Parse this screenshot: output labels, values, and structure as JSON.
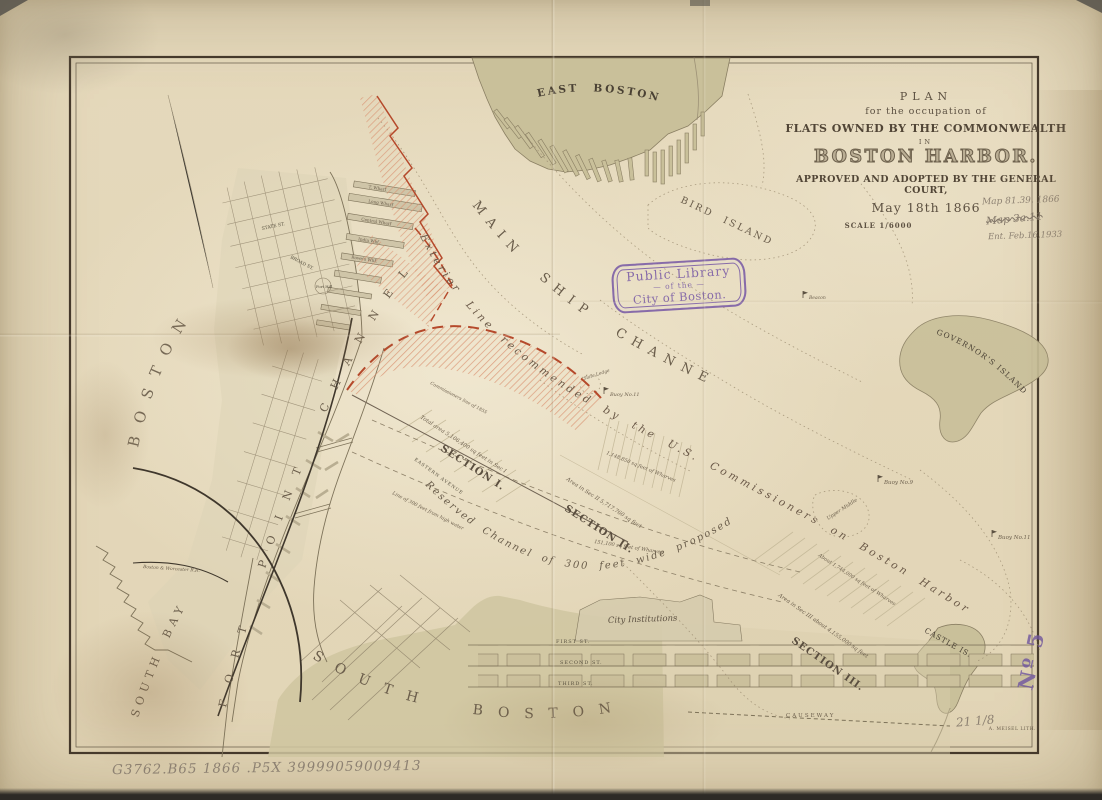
{
  "title_block": {
    "plan": "PLAN",
    "occupation": "for the occupation of",
    "flats": "FLATS OWNED BY THE COMMONWEALTH",
    "in_word": "IN",
    "harbor": "BOSTON HARBOR.",
    "approved": "APPROVED AND ADOPTED BY THE GENERAL COURT,",
    "date": "May 18th 1866",
    "scale": "SCALE 1/6000"
  },
  "manuscript": {
    "note1": "Map 81.39. 1866",
    "note2": "Map 3a.11",
    "note3": "Ent. Feb.16,1933",
    "catalog": "G3762.B65 1866 .P5X 39999059009413",
    "measure": "21 1/8"
  },
  "stamps": {
    "library_line1": "Public Library",
    "library_dash": "—",
    "library_line2": "of the",
    "library_line3": "City of Boston.",
    "number_stamp": "Nº 5"
  },
  "imprint": "A. MEISEL LITH.",
  "places": {
    "east_boston": "EAST BOSTON",
    "bird_island": "BIRD ISLAND",
    "governors_island": "GOVERNOR'S ISLAND",
    "castle_island": "CASTLE IS.",
    "boston": "BOSTON",
    "south_boston": "SOUTH BOSTON",
    "south_bay": "SOUTH BAY",
    "fort_point_channel": "FORT POINT CHANNEL",
    "main_ship_channel": "MAIN SHIP CHANNEL",
    "city_institutions": "City Institutions",
    "causeway": "CAUSEWAY",
    "fort_hill": "Fort Hill",
    "upper_middle": "Upper Middle",
    "slate_ledge": "Slate Ledge",
    "beacon": "Beacon"
  },
  "channel_text": {
    "exterior_line": "Exterior Line recommended by the U.S. Commissioners on Boston Harbor",
    "reserved_channel": "Reserved Channel of 300 feet wide proposed",
    "commissioners_1855": "Commissioners line of 1855"
  },
  "sections": {
    "s1": "SECTION I.",
    "s2": "SECTION II.",
    "s3": "SECTION III."
  },
  "buoys": {
    "buoy9": "Buoy No.9",
    "buoy11_mid": "Buoy No.11",
    "buoy11_east": "Buoy No.11"
  },
  "streets": {
    "first": "FIRST ST.",
    "second": "SECOND ST.",
    "third": "THIRD ST.",
    "state": "STATE ST.",
    "broad": "BROAD ST.",
    "eastern_avenue": "EASTERN AVENUE"
  },
  "wharves": {
    "t_wharf": "T. Wharf",
    "long_wharf": "Long Wharf",
    "central_wharf": "Central Wharf",
    "india_wharf": "India Whf.",
    "rowes_wharf": "Rowe's Whf."
  },
  "area_notes": {
    "sec1": "Total area 5,106,400 sq feet in Sec I",
    "sec2": "Area in Sec II 5,717,760 sq feet",
    "sec3": "Area in Sec III about 4,155,000 sq feet",
    "wharves2": "1,148,850 sq feet of Wharves",
    "wharves2b": "151,100 sq feet of Wharves",
    "wharves3": "About 1,744,000 sq feet of Wharves",
    "high_water": "Line of 300 feet from high water",
    "railroad": "Boston & Worcester R.R."
  },
  "colors": {
    "accent_red": "#b5492b",
    "stamp_purple": "#7a5ca6",
    "land_olive": "#c9c09a",
    "ink": "#574b3c",
    "pencil": "#8d8172",
    "paper": "#e5d9bc"
  }
}
